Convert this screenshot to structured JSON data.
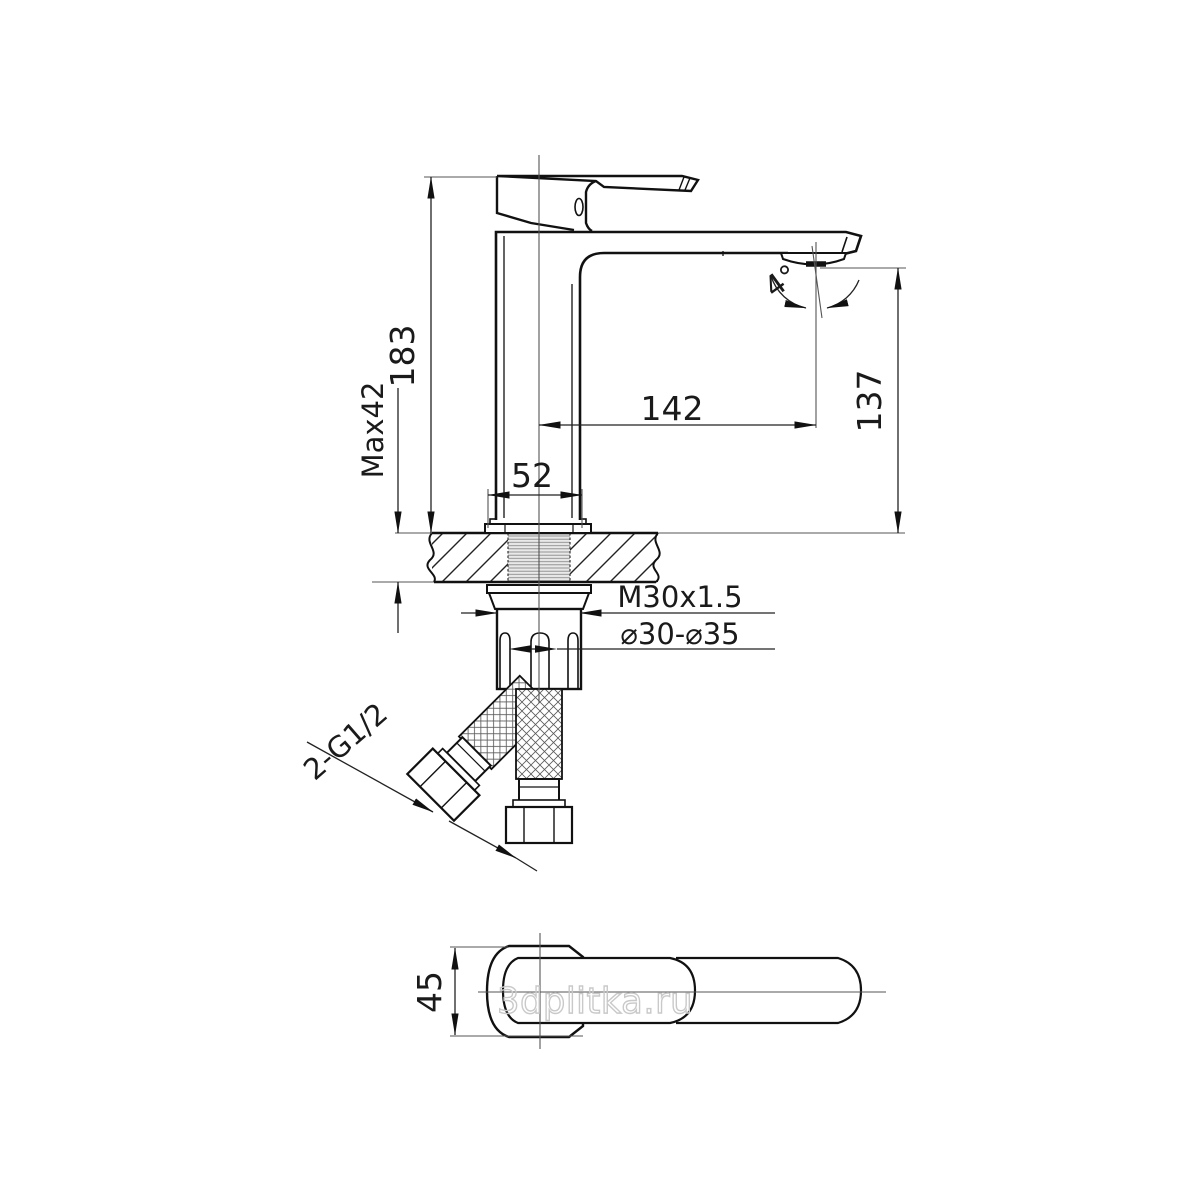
{
  "meta": {
    "watermark": "3dplitka.ru"
  },
  "drawing": {
    "type": "technical-dimension-drawing",
    "subject": "single-lever basin mixer faucet — front installation section and handle top view",
    "labels": {
      "total_height": "183",
      "max_deck_thickness": "Max42",
      "spout_reach": "142",
      "spout_outlet_height": "137",
      "base_width": "52",
      "outlet_angle": "4°",
      "mounting_thread": "M30x1.5",
      "hole_range": "⌀30-⌀35",
      "hose_thread": "2-G1/2",
      "body_width": "45"
    },
    "colors": {
      "outline": "#111111",
      "dimension_line": "#222222",
      "thin_line": "#555555",
      "thread_fill": "#e9e9e9",
      "watermark": "#c9c9c9",
      "background": "#ffffff"
    }
  }
}
